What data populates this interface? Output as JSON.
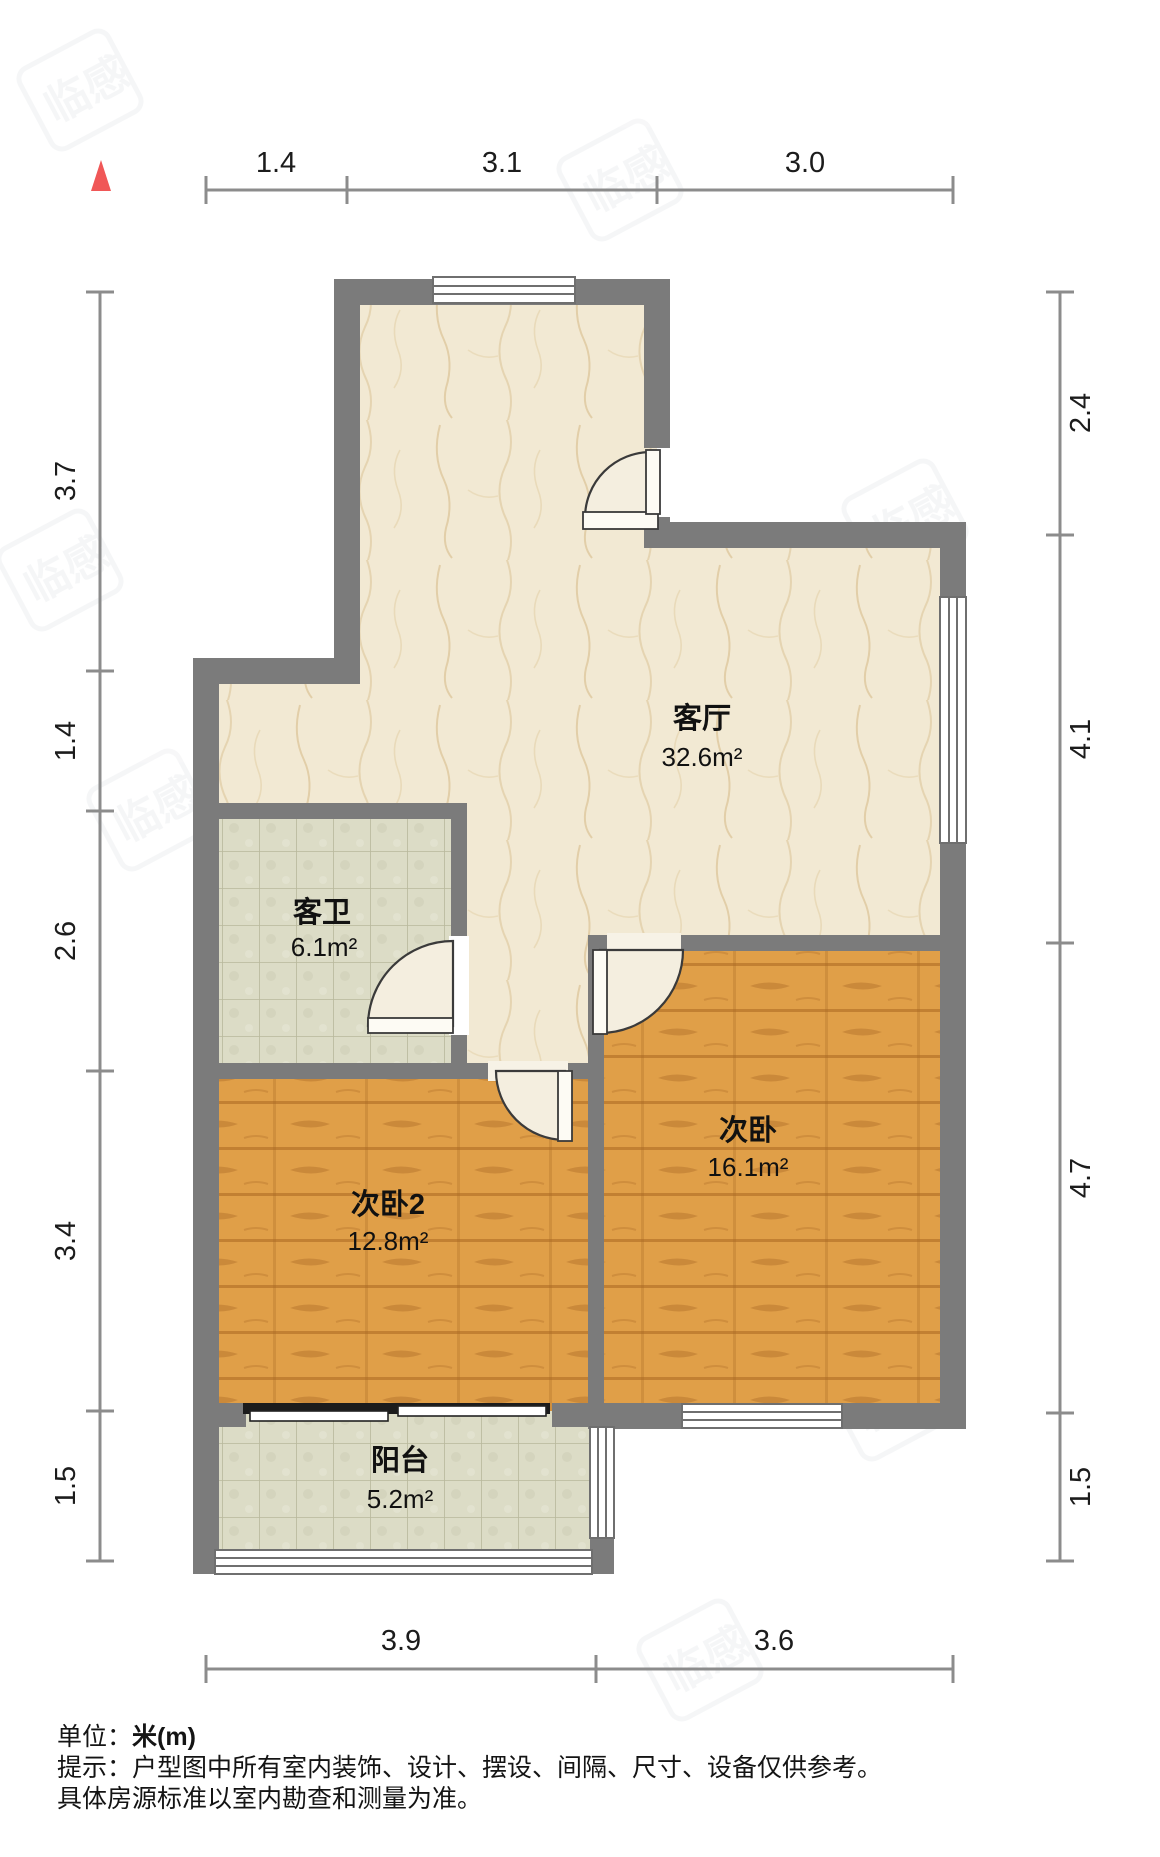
{
  "dims": {
    "top": [
      "1.4",
      "3.1",
      "3.0"
    ],
    "left": [
      "3.7",
      "1.4",
      "2.6",
      "3.4",
      "1.5"
    ],
    "right": [
      "2.4",
      "4.1",
      "4.7",
      "1.5"
    ],
    "bottom": [
      "3.9",
      "3.6"
    ]
  },
  "rooms": {
    "living": {
      "name": "客厅",
      "area": "32.6m²"
    },
    "bath": {
      "name": "客卫",
      "area": "6.1m²"
    },
    "bed": {
      "name": "次卧",
      "area": "16.1m²"
    },
    "bed2": {
      "name": "次卧2",
      "area": "12.8m²"
    },
    "balcony": {
      "name": "阳台",
      "area": "5.2m²"
    }
  },
  "footer": {
    "unit_label": "单位：",
    "unit_value": "米(m)",
    "tip": "提示：户型图中所有室内装饰、设计、摆设、间隔、尺寸、设备仅供参考。",
    "tip2": "具体房源标准以室内勘查和测量为准。"
  },
  "watermark_text": "临感",
  "colors": {
    "wall": "#7b7b7b",
    "living_floor": "#f2e9d3",
    "tile_floor": "#dcdcc6",
    "wood_floor": "#e09f48",
    "window_frame": "#6f6f6f",
    "door_line": "#3a3a3a",
    "dim_line": "#8c8c8c",
    "compass_red": "#f05757"
  }
}
